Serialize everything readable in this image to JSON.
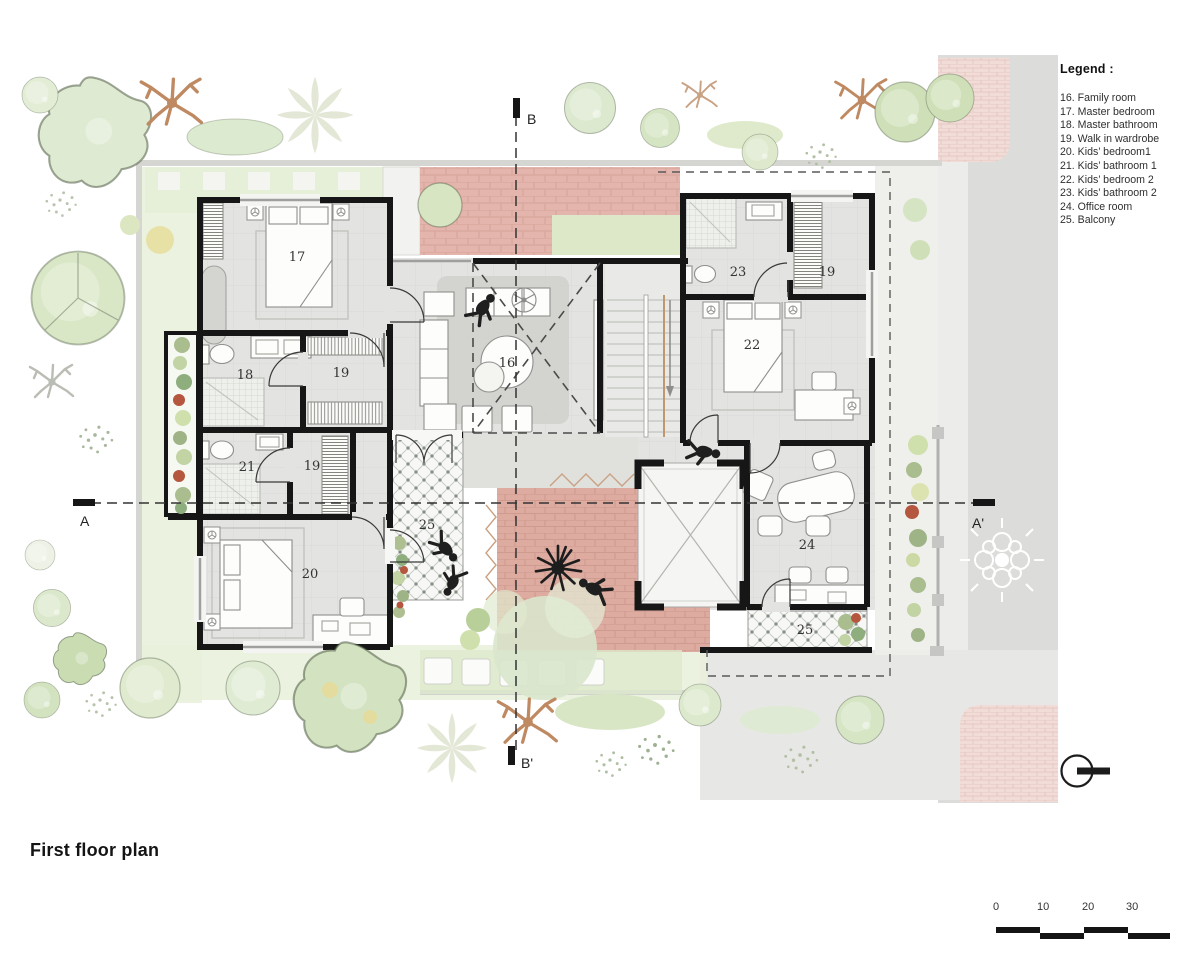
{
  "page": {
    "title": "First floor plan"
  },
  "legend": {
    "heading": "Legend :",
    "items": [
      "16. Family room",
      "17. Master bedroom",
      "18. Master bathroom",
      "19. Walk in wardrobe",
      "20. Kids’ bedroom1",
      "21. Kids’ bathroom 1",
      "22. Kids’ bedroom 2",
      "23. Kids’ bathroom 2",
      "24. Office room",
      "25. Balcony"
    ]
  },
  "rooms": {
    "r16": "16",
    "r17": "17",
    "r18": "18",
    "r19a": "19",
    "r19b": "19",
    "r19c": "19",
    "r20": "20",
    "r21": "21",
    "r22": "22",
    "r23": "23",
    "r24": "24",
    "r25a": "25",
    "r25b": "25"
  },
  "section_markers": {
    "a": "A",
    "a_prime": "A'",
    "b": "B",
    "b_prime": "B'"
  },
  "scale_bar": {
    "labels": [
      "0",
      "10",
      "20",
      "30"
    ]
  },
  "icons": {
    "north": "section-orientation-icon"
  },
  "colors": {
    "wall": "#161616",
    "floor": "#e3e4e1",
    "brick_terrace": "#e4b5ac",
    "brick_courtyard": "#ddab9f",
    "sidewalk_pink": "#f2dcd7",
    "road": "#dcddda",
    "lawn": "#e7efdb",
    "tree_tan": "#bf8a62"
  }
}
